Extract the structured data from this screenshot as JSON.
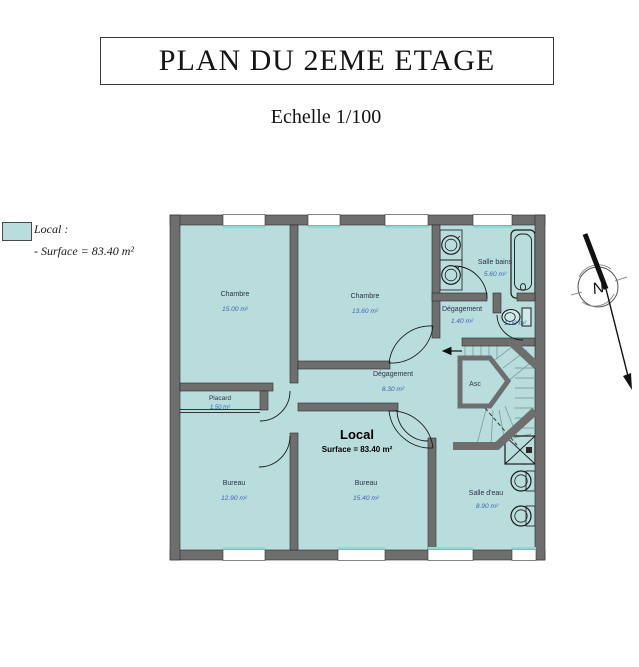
{
  "title": "PLAN DU 2EME ETAGE",
  "subtitle": "Echelle 1/100",
  "legend": {
    "title": "Local :",
    "surface_line": "- Surface = 83.40 m²"
  },
  "plan": {
    "local": {
      "name": "Local",
      "surface": "Surface = 83.40 m²"
    },
    "rooms": {
      "chambre1": {
        "name": "Chambre",
        "area": "15.00 m²"
      },
      "chambre2": {
        "name": "Chambre",
        "area": "13.60 m²"
      },
      "salle_bains": {
        "name": "Salle bains",
        "area": "5.60 m²"
      },
      "degagement1": {
        "name": "Dégagement",
        "area": "1.40 m²"
      },
      "wc": {
        "area": "1.00 m²"
      },
      "degagement2": {
        "name": "Dégagement",
        "area": "8.30 m²"
      },
      "ascenseur": {
        "name": "Asc"
      },
      "placard": {
        "name": "Placard",
        "area": "1.50 m²"
      },
      "bureau1": {
        "name": "Bureau",
        "area": "12.90 m²"
      },
      "bureau2": {
        "name": "Bureau",
        "area": "15.40 m²"
      },
      "salle_eau": {
        "name": "Salle d'eau",
        "area": "8.90 m²"
      }
    },
    "compass": {
      "label": "N"
    }
  },
  "colors": {
    "room_fill": "#b9dcdc",
    "wall": "#6e6e6e",
    "window_accent": "#8fd8d8",
    "area_text": "#3a67b8"
  }
}
